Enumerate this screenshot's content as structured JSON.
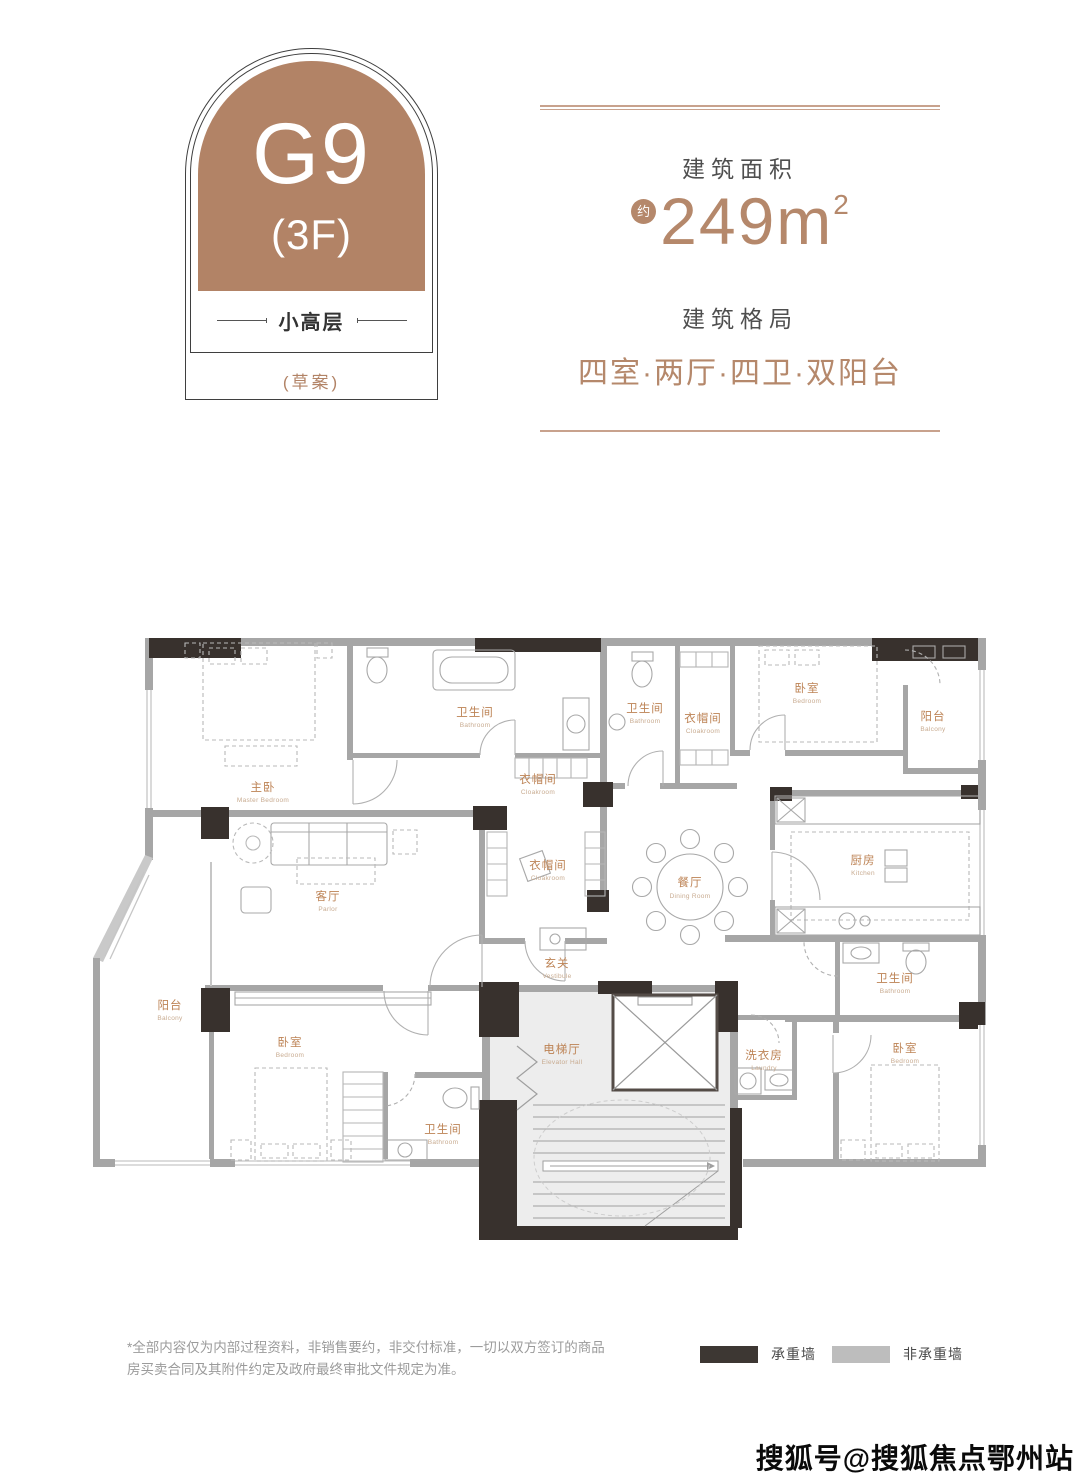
{
  "badge": {
    "unit": "G9",
    "floor": "(3F)",
    "type": "小高层",
    "note": "(草案)",
    "color": "#b28366"
  },
  "info": {
    "area_label": "建筑面积",
    "area_approx": "约",
    "area_value": "249",
    "area_unit": "m",
    "area_sup": "2",
    "layout_label": "建筑格局",
    "layout_value": "四室·两厅·四卫·双阳台"
  },
  "plan": {
    "rooms": [
      {
        "zh": "主卧",
        "en": "Master Bedroom"
      },
      {
        "zh": "卫生间",
        "en": "Bathroom"
      },
      {
        "zh": "衣帽间",
        "en": "Cloakroom"
      },
      {
        "zh": "卫生间",
        "en": "Bathroom"
      },
      {
        "zh": "衣帽间",
        "en": "Cloakroom"
      },
      {
        "zh": "卧室",
        "en": "Bedroom"
      },
      {
        "zh": "阳台",
        "en": "Balcony"
      },
      {
        "zh": "客厅",
        "en": "Parlor"
      },
      {
        "zh": "衣帽间",
        "en": "Cloakroom"
      },
      {
        "zh": "餐厅",
        "en": "Dining Room"
      },
      {
        "zh": "厨房",
        "en": "Kitchen"
      },
      {
        "zh": "玄关",
        "en": "Vestibule"
      },
      {
        "zh": "阳台",
        "en": "Balcony"
      },
      {
        "zh": "卧室",
        "en": "Bedroom"
      },
      {
        "zh": "卫生间",
        "en": "Bathroom"
      },
      {
        "zh": "电梯厅",
        "en": "Elevator Hall"
      },
      {
        "zh": "洗衣房",
        "en": "Laundry"
      },
      {
        "zh": "卫生间",
        "en": "Bathroom"
      },
      {
        "zh": "卧室",
        "en": "Bedroom"
      }
    ]
  },
  "legend": {
    "load_bearing": "承重墙",
    "non_load_bearing": "非承重墙",
    "load_color": "#3d3733",
    "non_load_color": "#bdbdbd"
  },
  "disclaimer": "*全部内容仅为内部过程资料，非销售要约，非交付标准，一切以双方签订的商品房买卖合同及其附件约定及政府最终审批文件规定为准。",
  "watermark": "搜狐号@搜狐焦点鄂州站"
}
